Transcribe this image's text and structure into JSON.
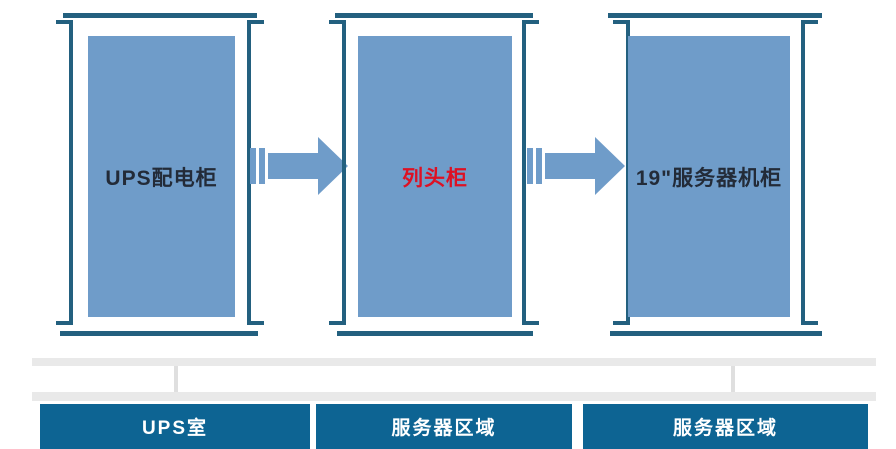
{
  "diagram": {
    "title": "power-distribution-flow",
    "cabinets": [
      {
        "label": "UPS配电柜",
        "label_color": "#232B38"
      },
      {
        "label": "列头柜",
        "label_color": "#DD1124"
      },
      {
        "label": "19\"服务器机柜",
        "label_color": "#232B38"
      }
    ],
    "arrows": [
      {
        "name": "flow-ups-to-row-head",
        "direction": "right"
      },
      {
        "name": "flow-row-head-to-rack",
        "direction": "right"
      }
    ],
    "zones": [
      {
        "label": "UPS室"
      },
      {
        "label": "服务器区域"
      },
      {
        "label": "服务器区域"
      }
    ],
    "colors": {
      "cabinet_fill": "#6F9CC9",
      "frame": "#23607F",
      "arrow_fill": "#6F9CC9",
      "label_dark": "#232B38",
      "label_red": "#DD1124",
      "gray_bar": "#E9E9E9",
      "connector_gray": "#DFDFDF",
      "zone_fill": "#0D6493",
      "zone_text": "#FFFFFF",
      "page_bg": "#FFFFFF"
    }
  }
}
